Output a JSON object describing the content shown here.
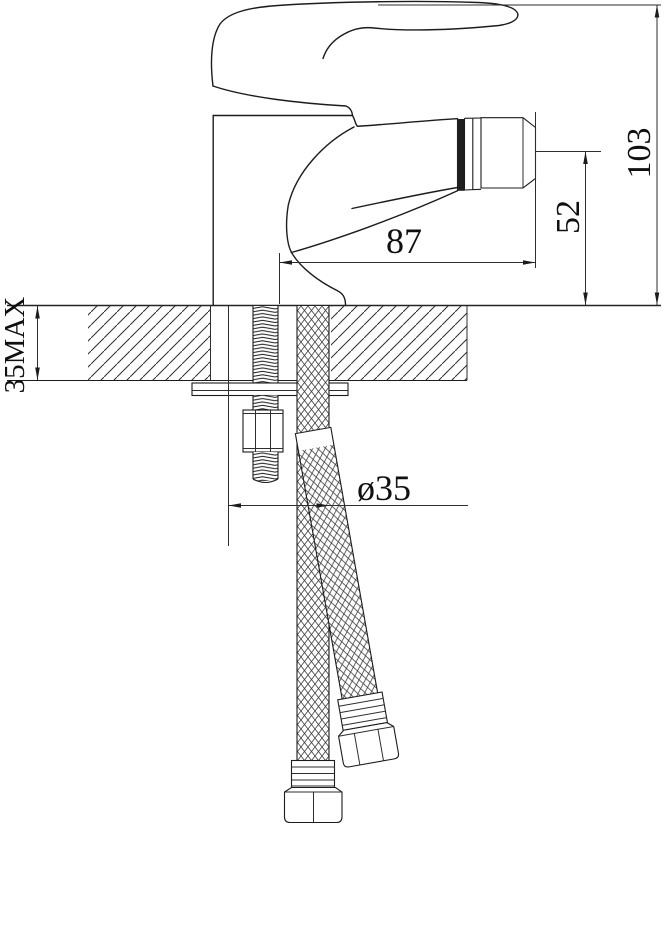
{
  "drawing": {
    "background": "#ffffff",
    "line_color": "#1c1c1c",
    "dimensions": {
      "overall_height": "103",
      "outlet_height": "52",
      "spout_reach": "87",
      "deck_thickness": "35MAX",
      "hole_diameter": "ø35"
    }
  }
}
